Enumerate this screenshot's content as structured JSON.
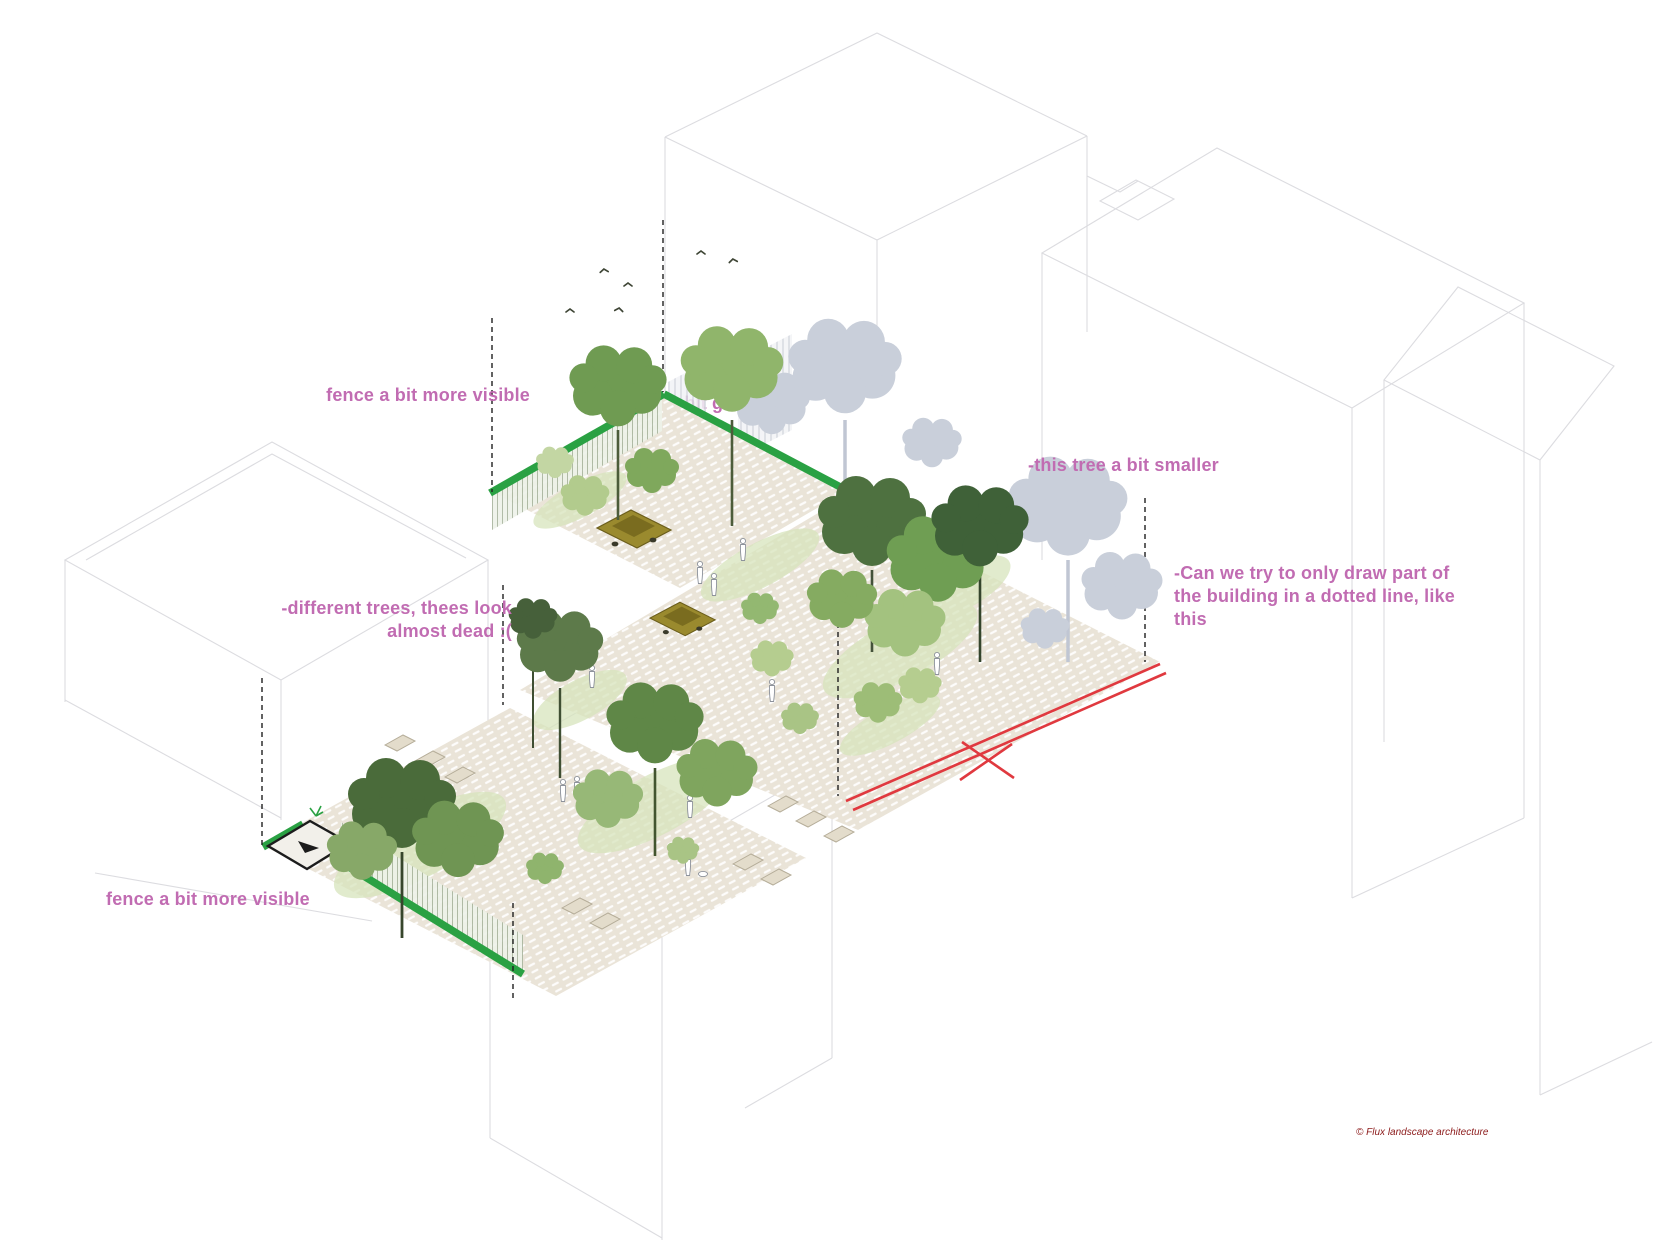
{
  "document": {
    "kind": "landscape axonometric design-review markup",
    "background": "#ffffff"
  },
  "annotations": {
    "fence_top": "fence a bit more visible",
    "green_partial": "-bit green",
    "tree_smaller": "-this tree a bit smaller",
    "dotted_building": "-Can we try to only draw part of\nthe building in a dotted line, like\nthis",
    "different_trees": "-different trees, thees look\nalmost dead :(",
    "fence_bottom": "fence a bit more visible"
  },
  "credit": "© Flux landscape architecture",
  "colors": {
    "annotation_pink": "#c16cb2",
    "fence_green": "#2aa143",
    "markup_red": "#e0393f",
    "credit_maroon": "#8c1b1b",
    "wireframe_gray": "#dcdce0",
    "ghost_tree_gray": "#c9cfda",
    "paving_beige": "#eae4d8"
  }
}
